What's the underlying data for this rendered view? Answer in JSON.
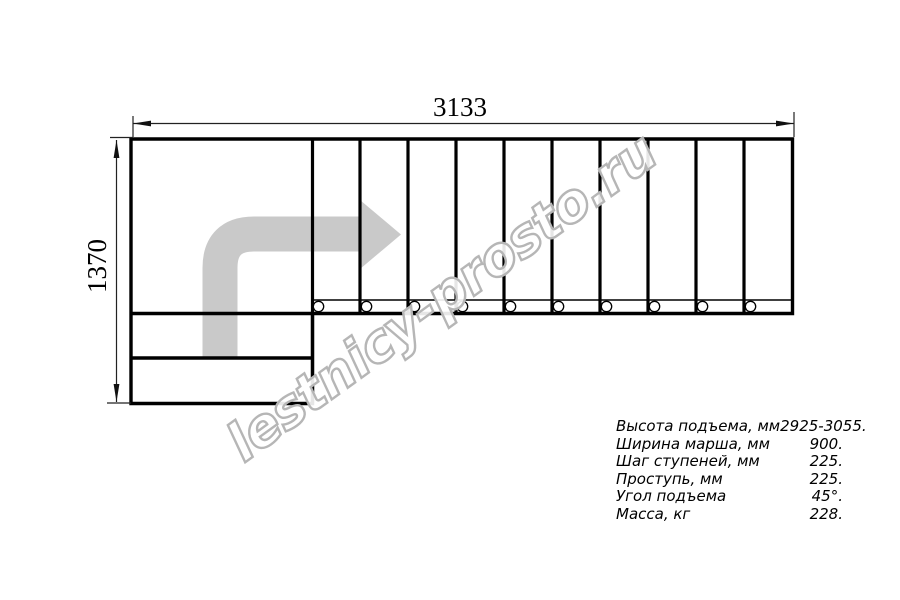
{
  "figure": {
    "type": "staircase-top-view-plan",
    "flight_treads": 10,
    "lower_steps": 2,
    "baluster_marks": 10,
    "arrow_color": "#c9c9c9",
    "line_color": "#000000",
    "watermark_color": "#b6b6b6"
  },
  "dimensions": {
    "width_label": "3133",
    "height_label": "1370"
  },
  "specs": {
    "rows": [
      {
        "label": "Высота подъема, мм",
        "value": "2925-3055."
      },
      {
        "label": "Ширина марша, мм",
        "value": "900."
      },
      {
        "label": "Шаг ступеней, мм",
        "value": "225."
      },
      {
        "label": "Проступь, мм",
        "value": "225."
      },
      {
        "label": "Угол подъема",
        "value": "45°."
      },
      {
        "label": "Масса, кг",
        "value": "228."
      }
    ]
  },
  "watermark": {
    "text": "lestnicy-prosto.ru"
  }
}
